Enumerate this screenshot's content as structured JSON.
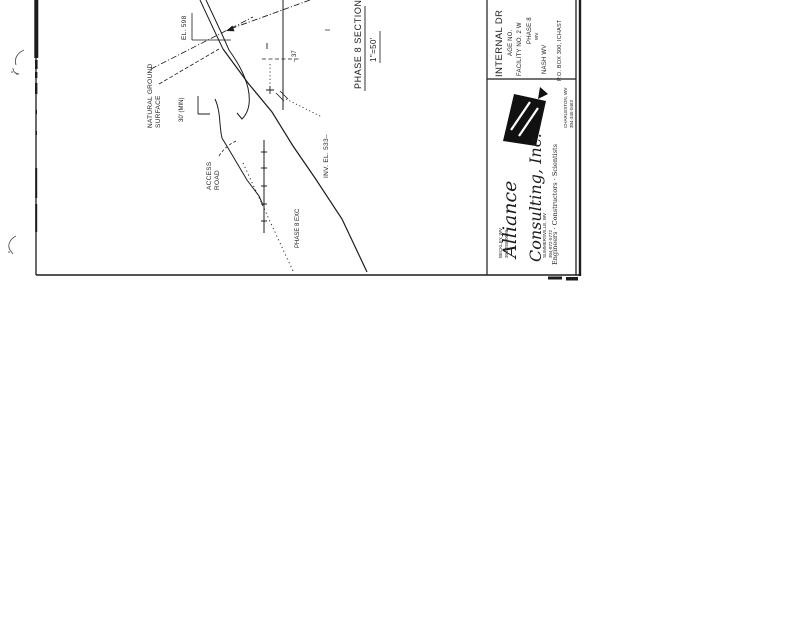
{
  "sheet": {
    "ink_color": "#1c1c1c",
    "section": {
      "title": "PHASE 8 SECTION",
      "scale": "1\"=50'"
    },
    "labels": {
      "crest_elevation": "EL. 598",
      "natural_ground_line1": "NATURAL GROUND",
      "natural_ground_line2": "SURFACE",
      "bench_width": "30' (MIN)",
      "access_road_line1": "ACCESS",
      "access_road_line2": "ROAD",
      "invert_elevation": "INV. EL. 533–",
      "offset_dim": "– 37",
      "phase_excavation": "PHASE 8 EXC"
    },
    "title_block": {
      "project_line1": "INTERNAL DR",
      "project_line2": "AGE NO.",
      "project_line3": "FACILITY NO. 2 W",
      "project_line4": "PHASE 8",
      "project_line5": "WV",
      "project_line6": "NASH WV",
      "address_edge": "P.O. BOX 300, ICHAST",
      "company": {
        "name_line1": "Alliance",
        "name_line2": "Consulting, Inc.",
        "tagline": "Engineers · Constructors · Scientists",
        "offices": [
          {
            "city": "BECKLEY, WV",
            "phone": "304-255-0686"
          },
          {
            "city": "SUMMERSVILLE, WV",
            "phone": "304-872-5772"
          },
          {
            "city": "CHARLESTON, WV",
            "phone": "304-345-0463"
          }
        ]
      }
    }
  }
}
